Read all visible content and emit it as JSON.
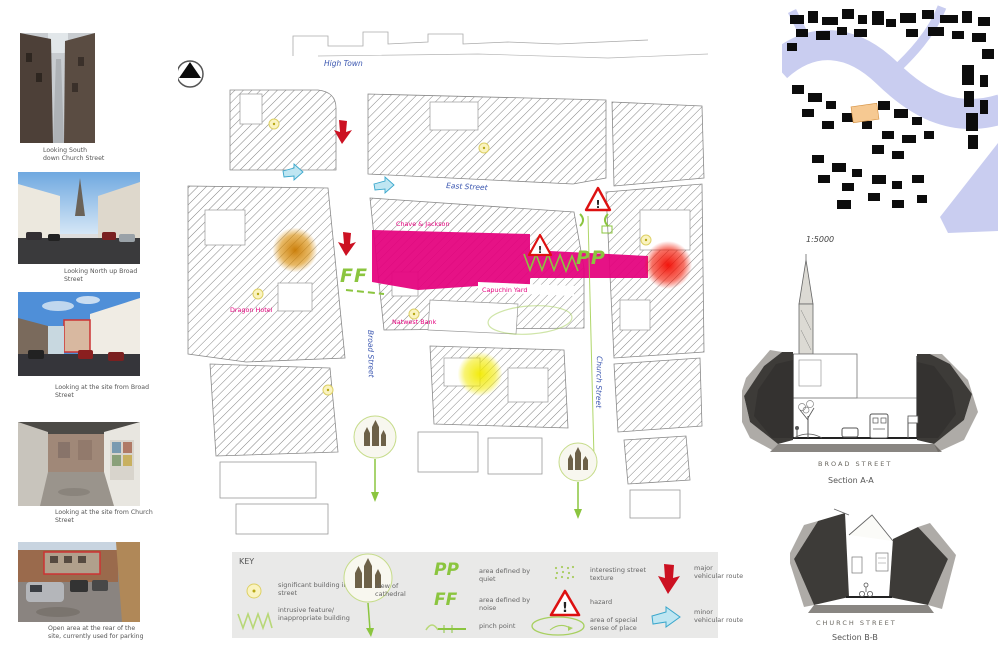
{
  "photos": [
    {
      "caption": "Looking South down Church Street"
    },
    {
      "caption": "Looking North up Broad Street"
    },
    {
      "caption": "Looking at the site from Broad Street"
    },
    {
      "caption": "Looking at the site from Church Street"
    },
    {
      "caption": "Open area at the rear of the site, currently used for parking"
    }
  ],
  "map": {
    "street_labels": {
      "high_town": "High Town",
      "east_street": "East Street",
      "broad_street": "Broad Street",
      "church_street": "Church Street"
    },
    "place_labels": {
      "chave_jackson": "Chave & Jackson",
      "dragon_hotel": "Dragon Hotel",
      "natwest_bank": "Natwest Bank",
      "capuchin_yard": "Capuchin Yard"
    },
    "annotations": {
      "ff": "FF",
      "pp": "PP",
      "hazard": "!"
    }
  },
  "key": {
    "title": "KEY",
    "items": [
      {
        "id": "significant-building",
        "label": "significant building in street"
      },
      {
        "id": "intrusive-feature",
        "label": "intrusive feature/ inappropriate building"
      },
      {
        "id": "view-of-cathedral",
        "label": "view of cathedral"
      },
      {
        "id": "area-quiet",
        "symbol": "PP",
        "label": "area defined by quiet"
      },
      {
        "id": "area-noise",
        "symbol": "FF",
        "label": "area defined by noise"
      },
      {
        "id": "pinch-point",
        "label": "pinch point"
      },
      {
        "id": "street-texture",
        "label": "interesting street texture"
      },
      {
        "id": "hazard",
        "label": "hazard"
      },
      {
        "id": "sense-of-place",
        "label": "area of special sense of place"
      },
      {
        "id": "major-route",
        "label": "major vehicular route"
      },
      {
        "id": "minor-route",
        "label": "minor vehicular route"
      }
    ]
  },
  "right_panel": {
    "figure_ground_scale": "1:5000",
    "section_a": {
      "street_label": "BROAD STREET",
      "caption": "Section A-A"
    },
    "section_b": {
      "street_label": "CHURCH STREET",
      "caption": "Section B-B"
    }
  },
  "colors": {
    "site_magenta": "#e4007d",
    "annotation_green": "#8bc53f",
    "street_label_blue": "#3a56b0",
    "major_route_red": "#cc1122",
    "minor_route_blue": "#bfe6f2",
    "hazard_red": "#dd1111",
    "glow_orange": "#c87800",
    "glow_red": "#f20800",
    "glow_yellow": "#f2ea00",
    "river_lavender": "#c9cdf0"
  }
}
